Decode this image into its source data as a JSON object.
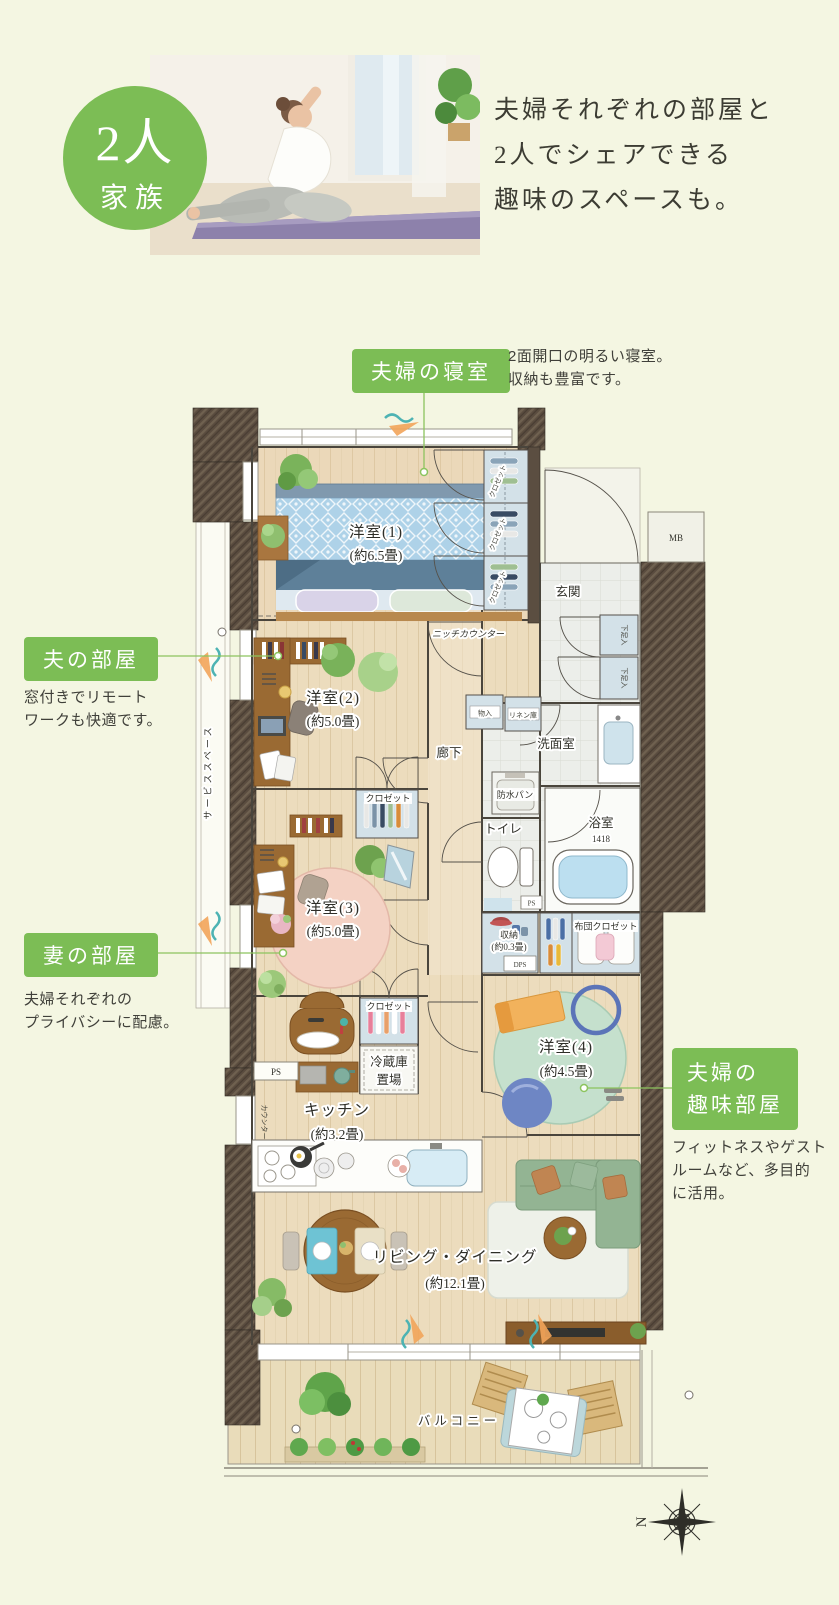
{
  "header": {
    "badge_line1": "2人",
    "badge_line2": "家族",
    "headline": [
      "夫婦それぞれの部屋と",
      "2人でシェアできる",
      "趣味のスペースも。"
    ]
  },
  "callouts": {
    "bedroom": {
      "label": "夫婦の寝室",
      "desc": [
        "2面開口の明るい寝室。",
        "収納も豊富です。"
      ]
    },
    "husband": {
      "label": "夫の部屋",
      "desc": [
        "窓付きでリモート",
        "ワークも快適です。"
      ]
    },
    "wife": {
      "label": "妻の部屋",
      "desc": [
        "夫婦それぞれの",
        "プライバシーに配慮。"
      ]
    },
    "hobby": {
      "label": [
        "夫婦の",
        "趣味部屋"
      ],
      "desc": [
        "フィットネスやゲスト",
        "ルームなど、多目的",
        "に活用。"
      ]
    }
  },
  "plan": {
    "rooms": {
      "bedroom1": {
        "name": "洋室(1)",
        "size": "(約6.5畳)"
      },
      "bedroom2": {
        "name": "洋室(2)",
        "size": "(約5.0畳)"
      },
      "bedroom3": {
        "name": "洋室(3)",
        "size": "(約5.0畳)"
      },
      "bedroom4": {
        "name": "洋室(4)",
        "size": "(約4.5畳)"
      },
      "living": {
        "name": "リビング・ダイニング",
        "size": "(約12.1畳)"
      },
      "kitchen": {
        "name": "キッチン",
        "size": "(約3.2畳)"
      },
      "entrance": "玄関",
      "hallway": "廊下",
      "washroom": "洗面室",
      "bathroom": "浴室",
      "bathroom_size": "1418",
      "toilet": "トイレ",
      "balcony": "バルコニー",
      "service_space": "サービススペース"
    },
    "fixtures": {
      "closet": "クロゼット",
      "futon_closet": "布団クロゼット",
      "storage": "収納",
      "storage_size": "(約0.3畳)",
      "shoe_cabinet": "下足入",
      "storage_small": "物入",
      "linen": "リネン庫",
      "niche_counter": "ニッチカウンター",
      "waterproof_pan": "防水パン",
      "fridge_line1": "冷蔵庫",
      "fridge_line2": "置場",
      "counter": "カウンター",
      "mb": "MB",
      "ps": "PS",
      "dps": "DPS",
      "north": "N"
    }
  },
  "colors": {
    "accent_green": "#7cbd55",
    "leader_green": "#8cc45e",
    "wall_brown": "#5a4c3f",
    "background": "#f4f6e2"
  }
}
